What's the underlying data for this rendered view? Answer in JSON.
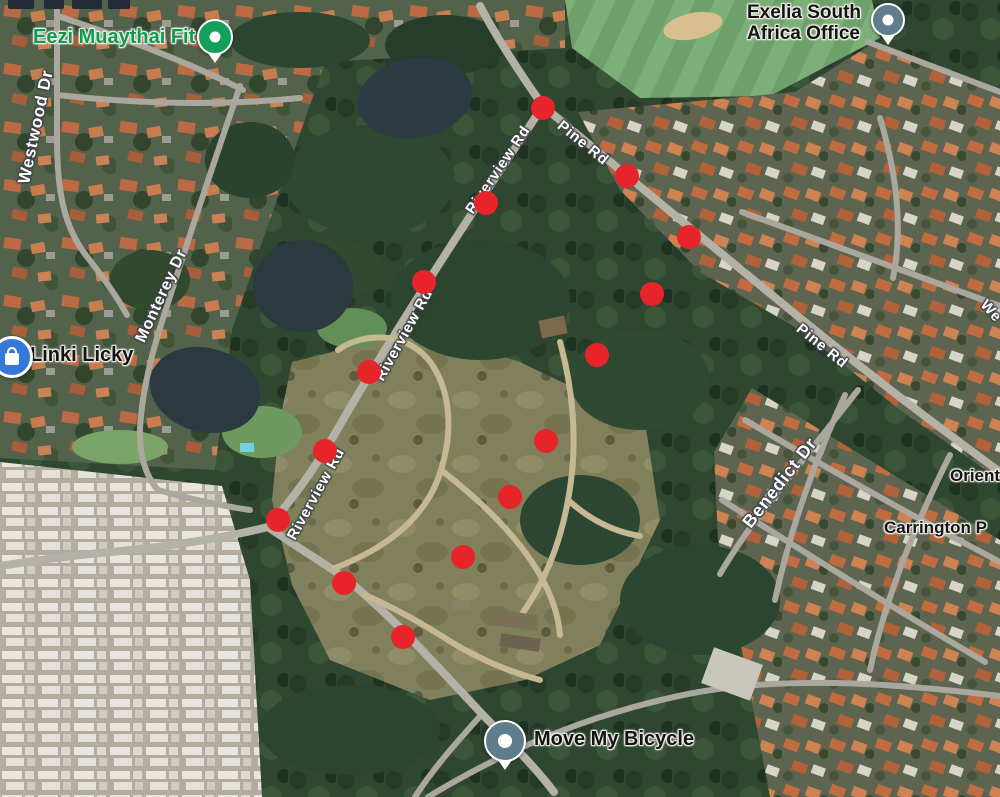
{
  "map": {
    "view": "satellite",
    "marker_color": "#e8242b",
    "markers": [
      {
        "x": 543,
        "y": 108
      },
      {
        "x": 486,
        "y": 203
      },
      {
        "x": 424,
        "y": 282
      },
      {
        "x": 369,
        "y": 372
      },
      {
        "x": 325,
        "y": 451
      },
      {
        "x": 278,
        "y": 520
      },
      {
        "x": 344,
        "y": 583
      },
      {
        "x": 403,
        "y": 637
      },
      {
        "x": 463,
        "y": 557
      },
      {
        "x": 510,
        "y": 497
      },
      {
        "x": 546,
        "y": 441
      },
      {
        "x": 597,
        "y": 355
      },
      {
        "x": 652,
        "y": 294
      },
      {
        "x": 689,
        "y": 237
      },
      {
        "x": 627,
        "y": 176
      }
    ],
    "road_labels": {
      "westwood": "Westwood Dr",
      "monterey": "Monterey Dr",
      "riverview": "Riverview Rd",
      "pine": "Pine Rd",
      "benedict": "Benedict Dr",
      "west_partial": "We"
    },
    "places": {
      "eezi": {
        "name": "Eezi Muaythai Fit",
        "label_color": "#0e9b4f",
        "pin_color": "#12a05a"
      },
      "linki": {
        "name": "Linki Licky",
        "icon_color": "#3579d8"
      },
      "exelia": {
        "line1": "Exelia South",
        "line2": "Africa Office",
        "pin_color": "#5f7d8c"
      },
      "move": {
        "name": "Move My Bicycle",
        "pin_color": "#5f7d8c"
      },
      "carrington": {
        "name": "Carrington P"
      },
      "orient": {
        "name": "Orient"
      }
    }
  }
}
